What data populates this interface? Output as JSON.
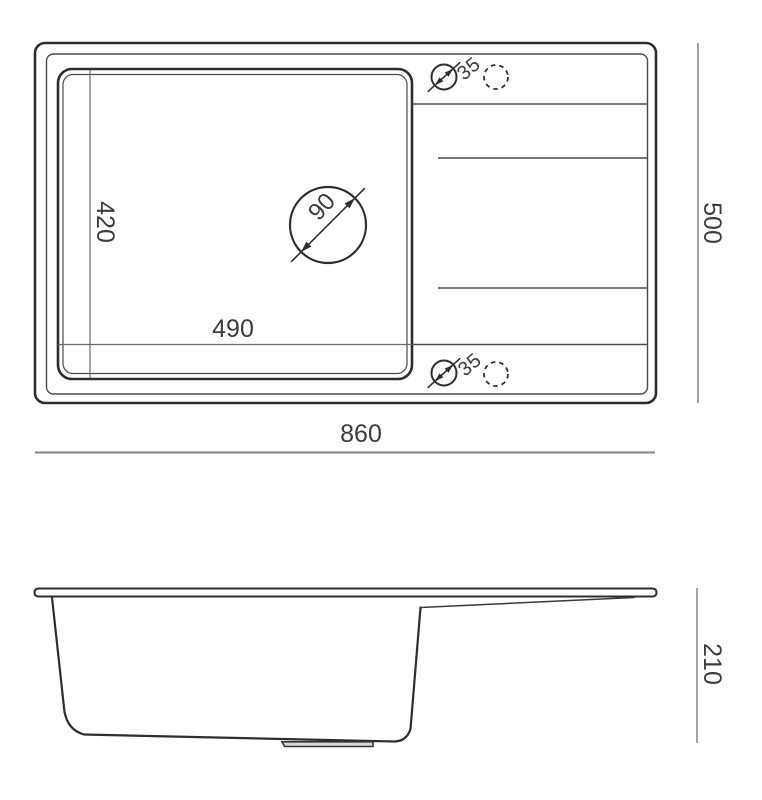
{
  "drawing": {
    "title": "sink-technical-drawing",
    "top_view": {
      "overall_width_mm": "860",
      "overall_depth_mm": "500",
      "bowl_width_mm": "490",
      "bowl_depth_mm": "420",
      "drain_hole_diameter_mm": "90",
      "tap_hole_top_diameter_mm": "35",
      "tap_hole_bottom_diameter_mm": "35"
    },
    "side_view": {
      "overall_height_mm": "210"
    },
    "colors": {
      "outline": "#2e2e2e",
      "thin_line": "#4a4a4a",
      "dimension_line": "#8c8c8c",
      "label_text": "#3c3c3c",
      "background": "#ffffff"
    }
  }
}
